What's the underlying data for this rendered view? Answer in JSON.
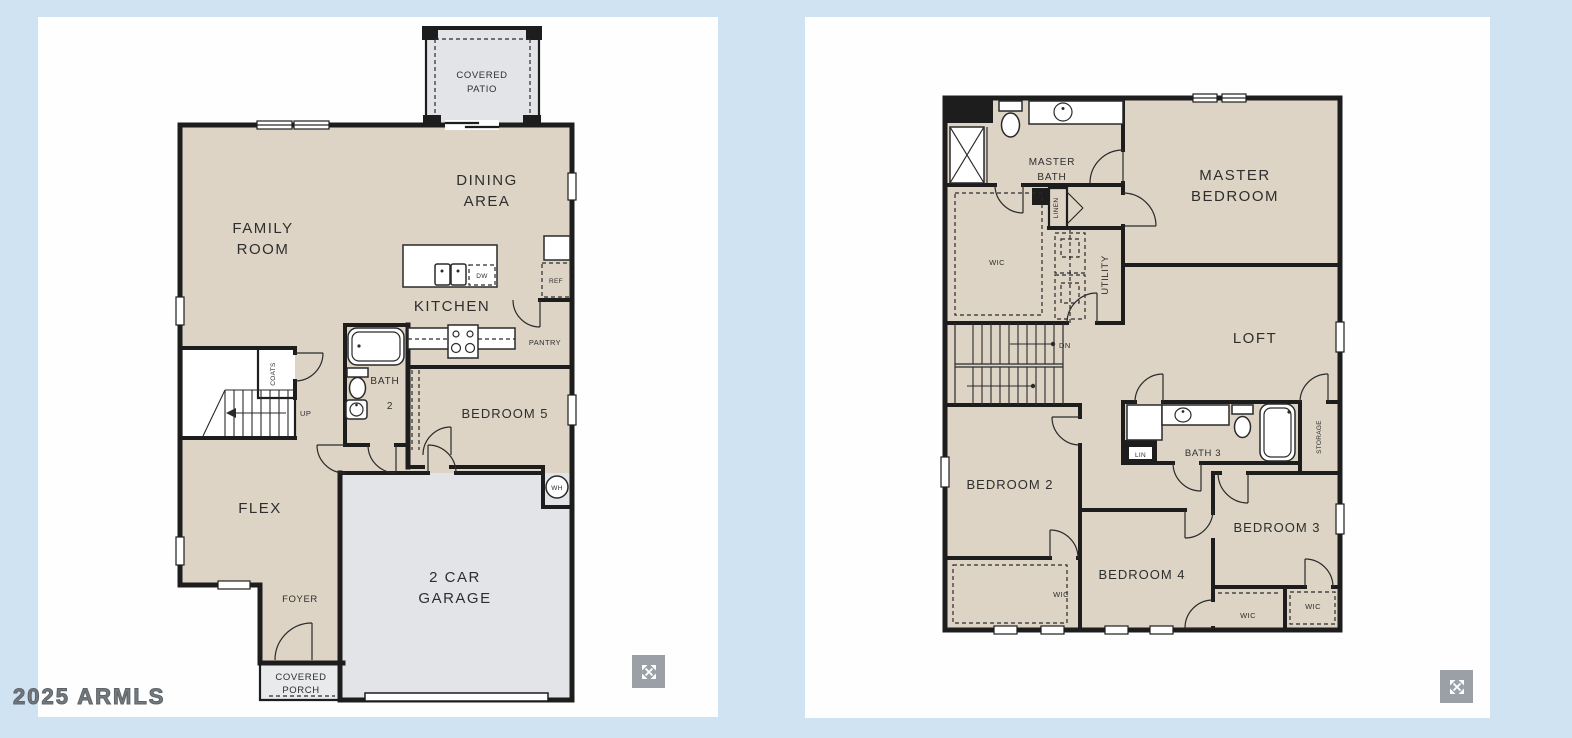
{
  "watermark": "2025 ARMLS",
  "colors": {
    "background": "#cfe3f2",
    "panel": "#fefefe",
    "floor": "#ddd4c5",
    "garage": "#e2e4e7",
    "porch": "#e9eaec",
    "wall": "#1d1d1d",
    "icon_gray": "#9aa0a5"
  },
  "floor1": {
    "covered_patio_line1": "COVERED",
    "covered_patio_line2": "PATIO",
    "dining_line1": "DINING",
    "dining_line2": "AREA",
    "family_line1": "FAMILY",
    "family_line2": "ROOM",
    "kitchen": "KITCHEN",
    "dw": "DW",
    "ref": "REF",
    "pantry": "PANTRY",
    "bath_line1": "BATH",
    "bath_line2": "2",
    "bedroom5": "BEDROOM 5",
    "coats": "COATS",
    "up": "UP",
    "wh": "WH",
    "flex": "FLEX",
    "foyer": "FOYER",
    "porch_line1": "COVERED",
    "porch_line2": "PORCH",
    "garage_line1": "2 CAR",
    "garage_line2": "GARAGE"
  },
  "floor2": {
    "master_bath_line1": "MASTER",
    "master_bath_line2": "BATH",
    "master_bedroom_line1": "MASTER",
    "master_bedroom_line2": "BEDROOM",
    "wic_master": "WIC",
    "linen": "LINEN",
    "utility": "UTILITY",
    "loft": "LOFT",
    "dn": "DN",
    "bedroom2": "BEDROOM 2",
    "bath3": "BATH 3",
    "lin": "LIN",
    "storage": "STORAGE",
    "bedroom3": "BEDROOM 3",
    "bedroom4": "BEDROOM 4",
    "wic_bedroom2": "WIC",
    "wic_bedroom4": "WIC",
    "wic_bedroom3": "WIC"
  }
}
